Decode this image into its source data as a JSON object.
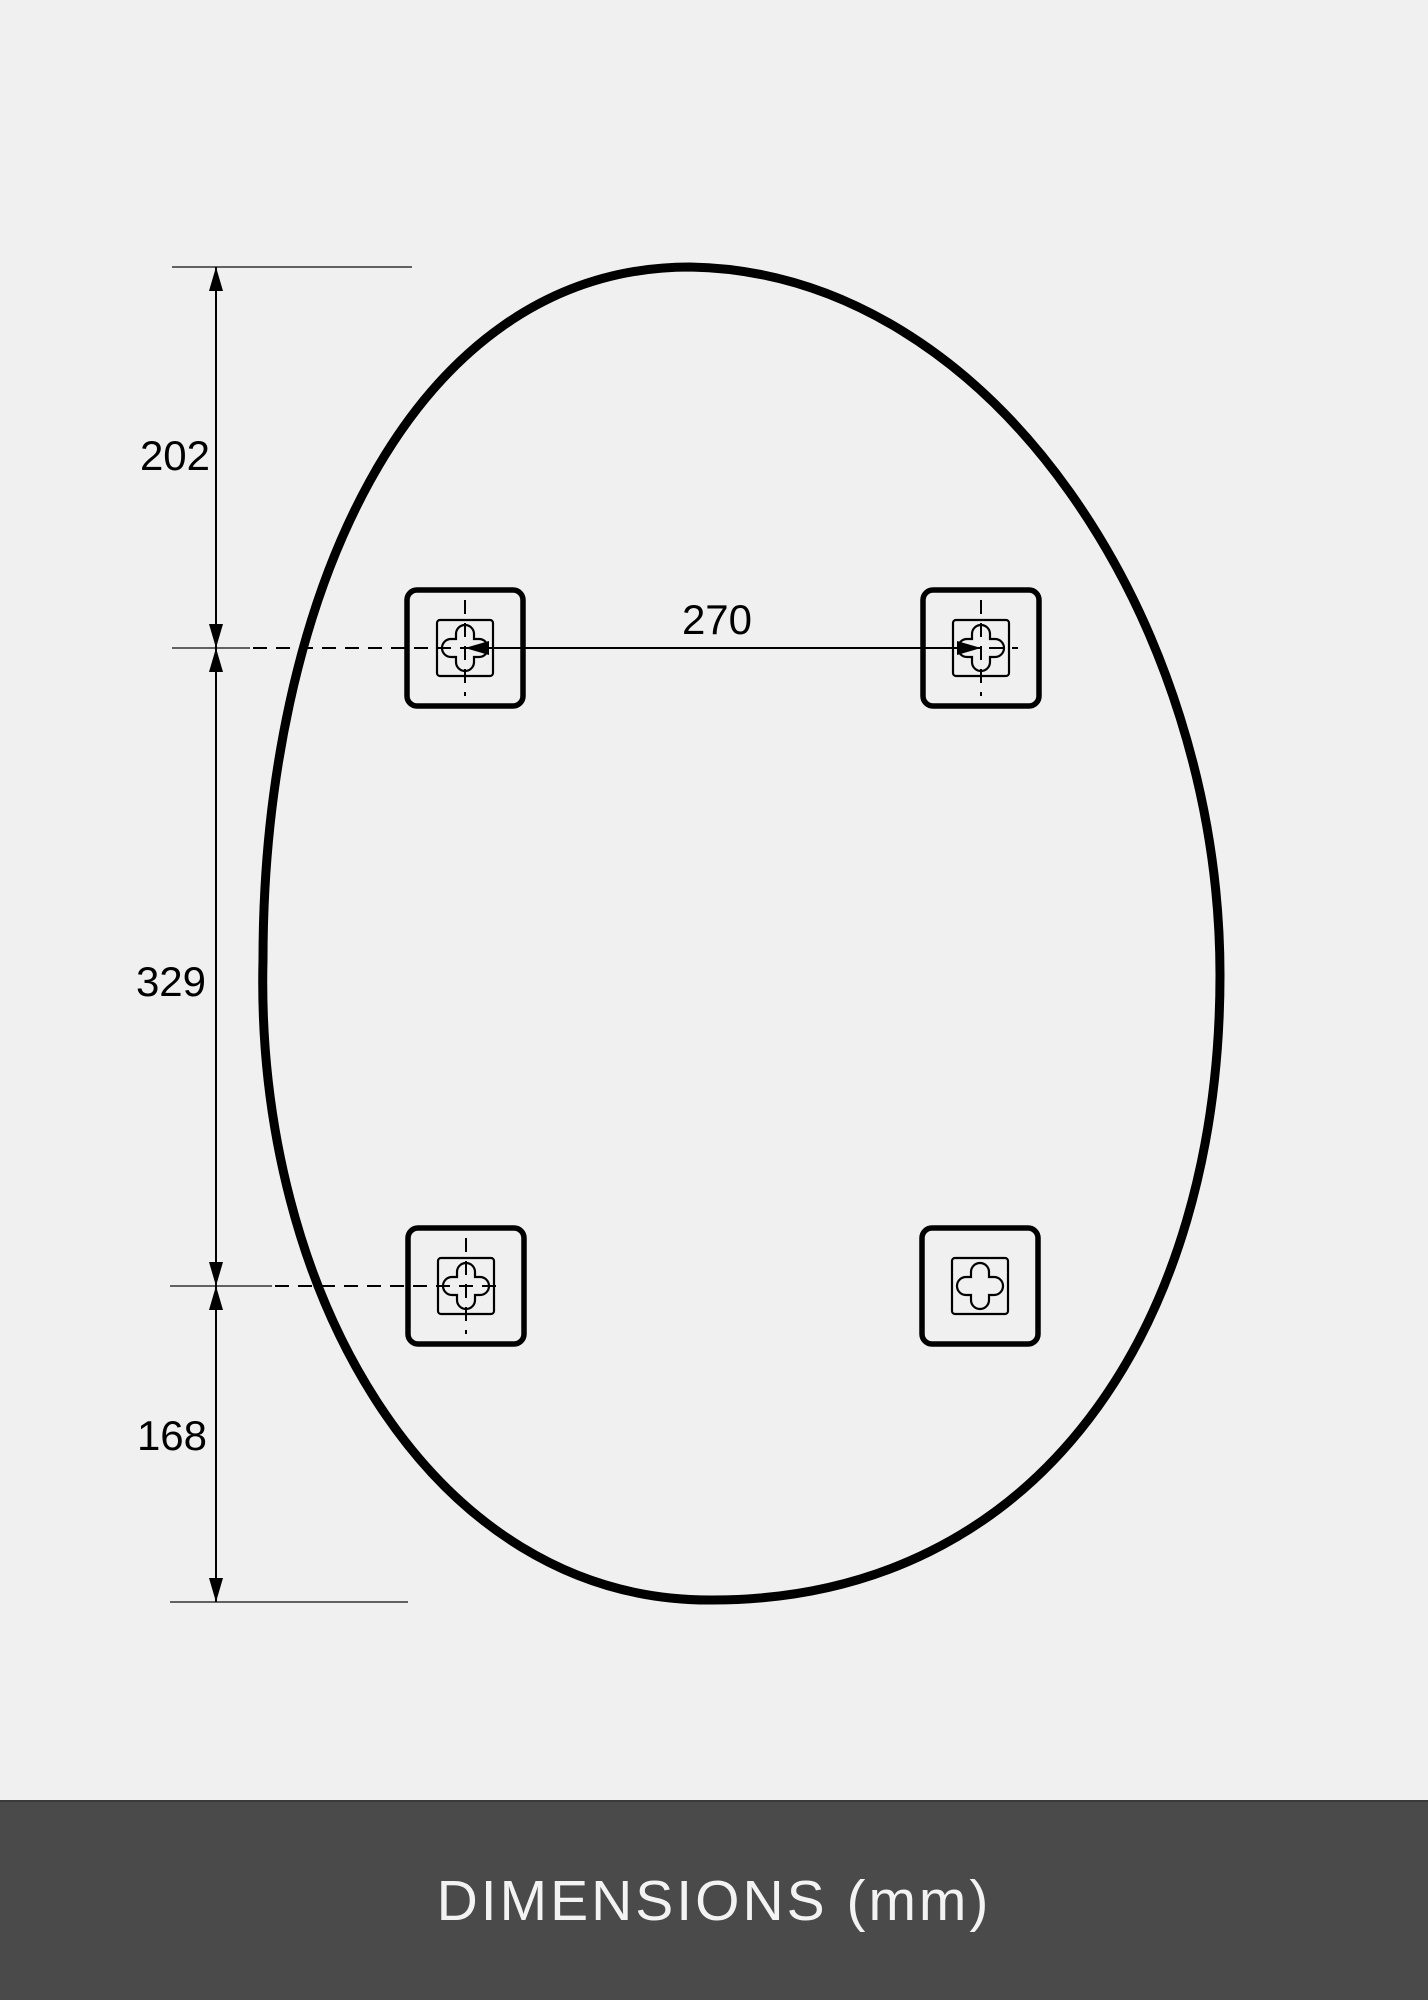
{
  "diagram": {
    "type": "technical-dimension-drawing",
    "units": "mm",
    "vertical_dimensions": [
      {
        "label": "202"
      },
      {
        "label": "329"
      },
      {
        "label": "168"
      }
    ],
    "horizontal_dimension": {
      "label": "270"
    },
    "mounting_brackets": [
      {
        "position": "top-left"
      },
      {
        "position": "top-right"
      },
      {
        "position": "bottom-left"
      },
      {
        "position": "bottom-right"
      }
    ]
  },
  "footer": {
    "label": "DIMENSIONS (mm)"
  },
  "colors": {
    "background": "#f0f0f1",
    "line": "#000000",
    "footer_bar": "#4a4a4a",
    "footer_text": "#f3f3f3"
  }
}
